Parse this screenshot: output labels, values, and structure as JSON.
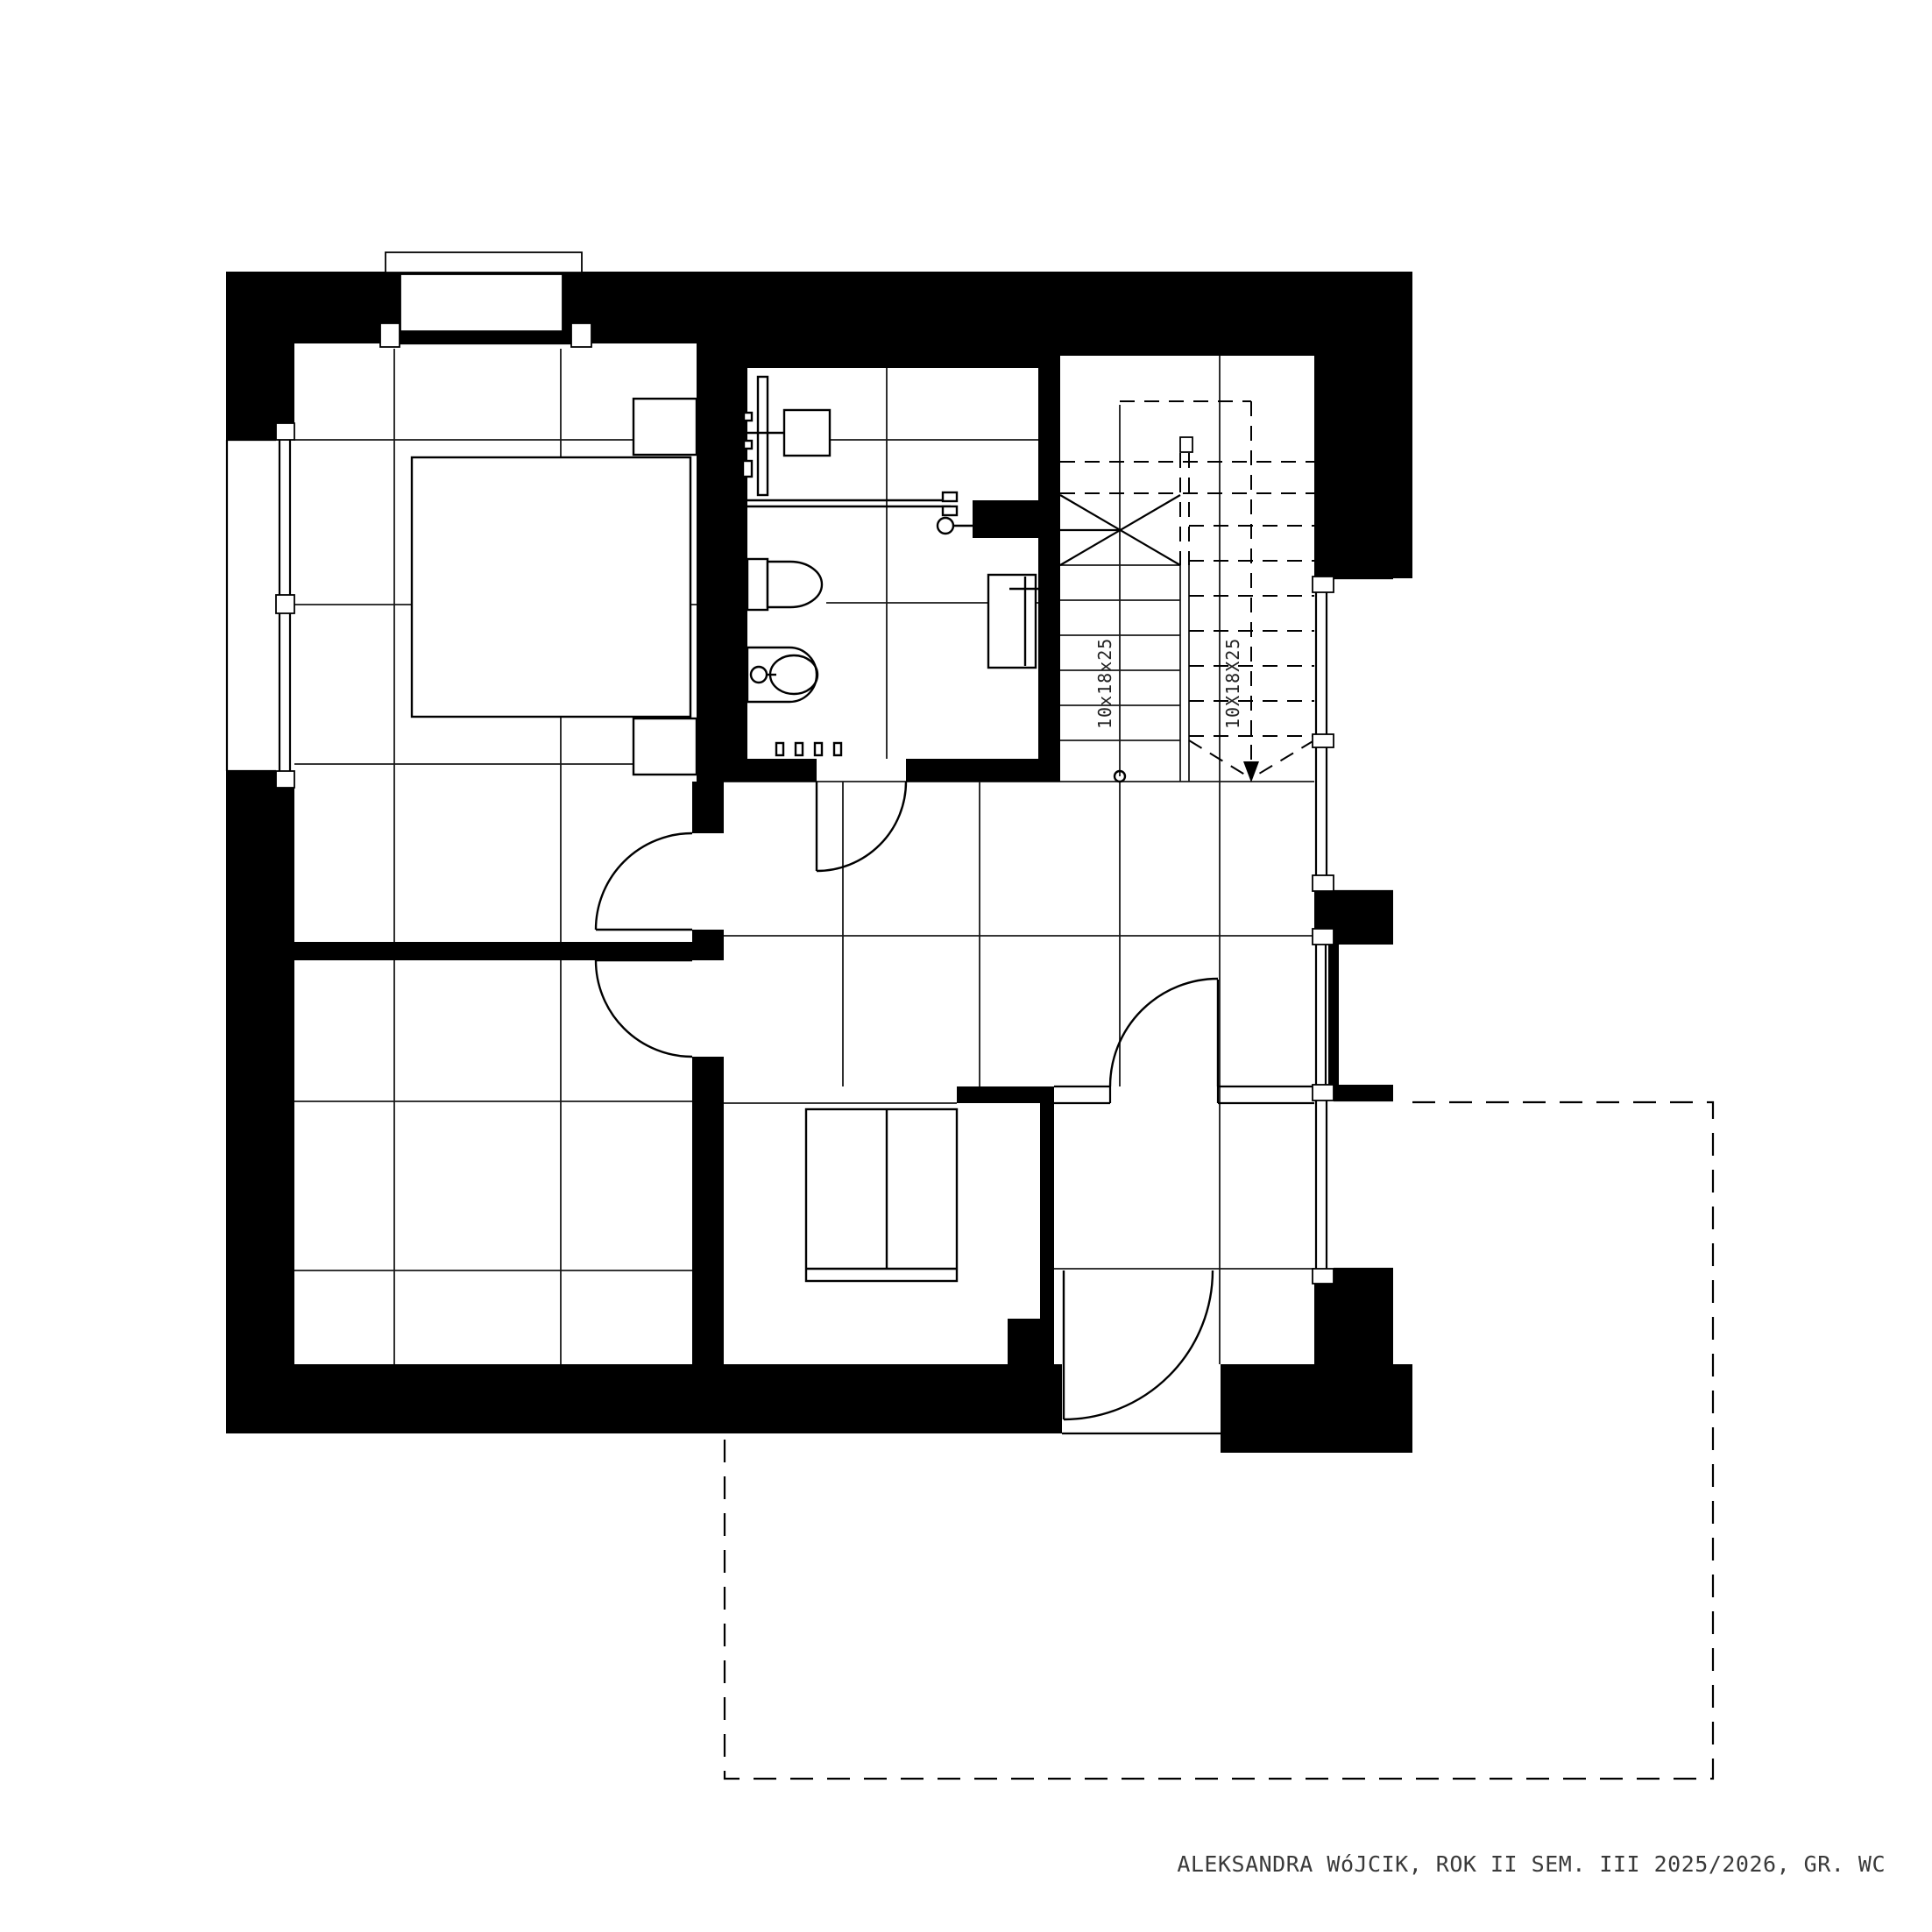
{
  "drawing": {
    "type": "architectural floor plan",
    "caption": "ALEKSANDRA WóJCIK, ROK II SEM. III 2025/2026, GR. WC",
    "stair_labels": {
      "left": "10x18x25",
      "right": "10X18X25"
    },
    "colors": {
      "background": "#ffffff",
      "walls": "#000000",
      "lines": "#1a1a1a",
      "caption_text": "#3a3a3a"
    }
  }
}
